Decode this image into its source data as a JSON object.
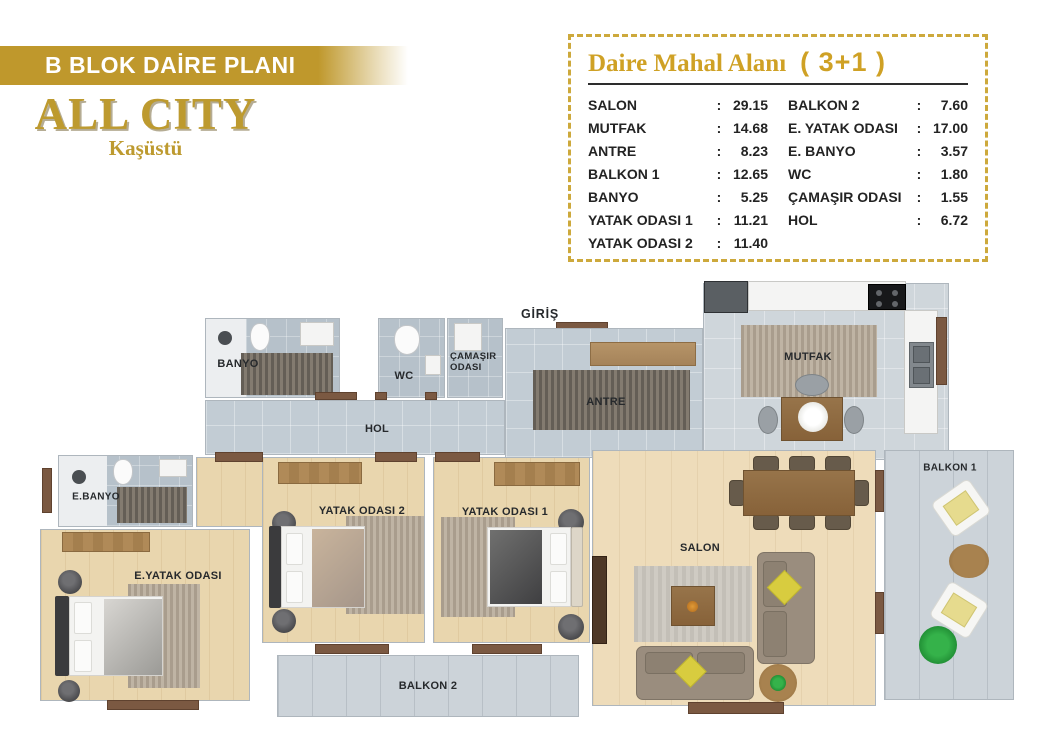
{
  "header": {
    "banner_text": "B BLOK DAİRE PLANI",
    "project_title": "ALL CITY",
    "project_subtitle": "Kaşüstü",
    "brand_gold": "#bf982c"
  },
  "area_table": {
    "title": "Daire Mahal Alanı",
    "plan_type": "( 3+1 )",
    "separator": ":",
    "border_gold": "#cda93c",
    "title_gold": "#cfa125",
    "left_rows": [
      {
        "name": "SALON",
        "value": "29.15"
      },
      {
        "name": "MUTFAK",
        "value": "14.68"
      },
      {
        "name": "ANTRE",
        "value": "8.23"
      },
      {
        "name": "BALKON 1",
        "value": "12.65"
      },
      {
        "name": "BANYO",
        "value": "5.25"
      },
      {
        "name": "YATAK ODASI 1",
        "value": "11.21"
      },
      {
        "name": "YATAK ODASI 2",
        "value": "11.40"
      }
    ],
    "right_rows": [
      {
        "name": "BALKON 2",
        "value": "7.60"
      },
      {
        "name": "E. YATAK ODASI",
        "value": "17.00"
      },
      {
        "name": "E. BANYO",
        "value": "3.57"
      },
      {
        "name": "WC",
        "value": "1.80"
      },
      {
        "name": "ÇAMAŞIR ODASI",
        "value": "1.55"
      },
      {
        "name": "HOL",
        "value": "6.72"
      }
    ]
  },
  "floor_plan": {
    "labels": {
      "giris": "GİRİŞ",
      "banyo": "BANYO",
      "wc": "WC",
      "camasir_odasi": "ÇAMAŞIR ODASI",
      "hol": "HOL",
      "antre": "ANTRE",
      "mutfak": "MUTFAK",
      "e_banyo": "E.BANYO",
      "e_yatak_odasi": "E.YATAK ODASI",
      "yatak_odasi_2": "YATAK ODASI 2",
      "yatak_odasi_1": "YATAK ODASI 1",
      "salon": "SALON",
      "balkon_1": "BALKON 1",
      "balkon_2": "BALKON 2"
    },
    "palette": {
      "wood_floor": "#e9d6ae",
      "salon_floor": "#eedcba",
      "hall_tile": "#c2ccd4",
      "bath_tile": "#b6c1ca",
      "kitchen_floor": "#cfd6db",
      "balcony_tile": "#ccd3d9",
      "door_wood": "#7b5942",
      "sofa": "#9a8d7e",
      "pillow_yellow": "#d8cc3f",
      "plant_green": "#2f9e3a"
    }
  }
}
